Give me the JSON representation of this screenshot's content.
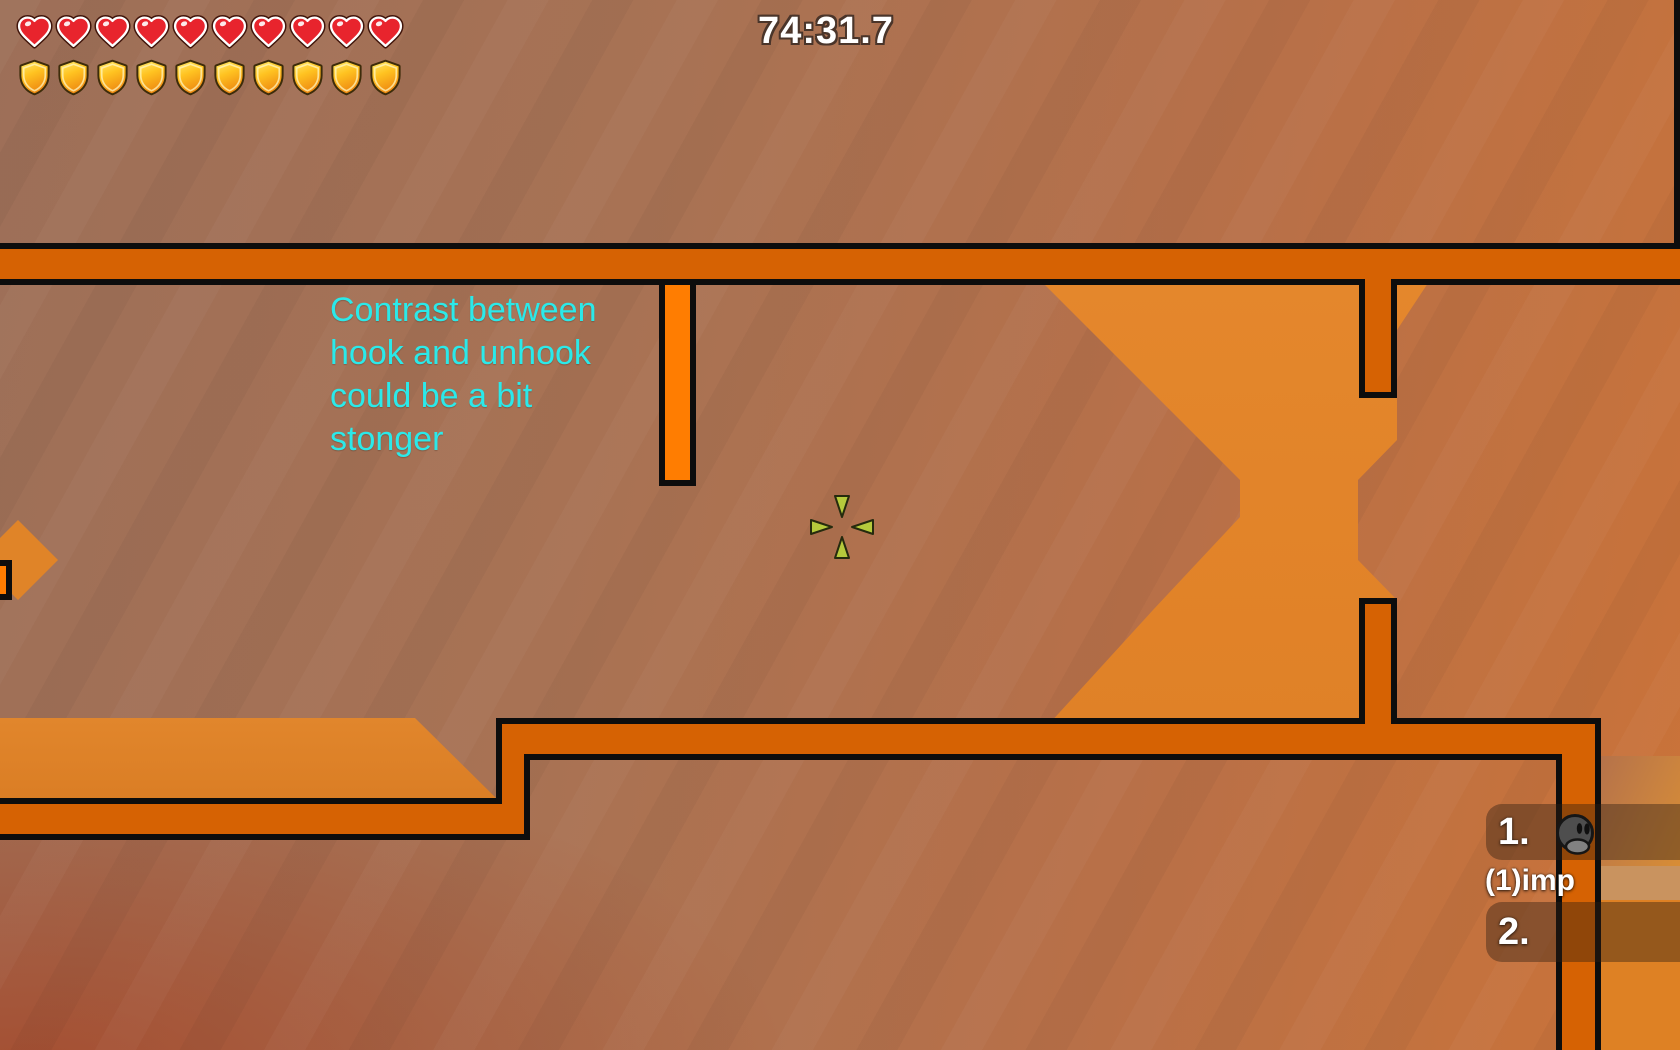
{
  "hud": {
    "timer": "74:31.7",
    "health": 10,
    "armor": 10,
    "health_icon": "heart-icon",
    "armor_icon": "shield-icon"
  },
  "broadcast": {
    "text": "Contrast between\nhook and unhook\ncould be a bit\nstonger",
    "color": "#2BE9E9"
  },
  "spectator_panel": {
    "rows": [
      {
        "rank": "1."
      },
      {
        "rank": "2."
      }
    ],
    "player_name": "(1)imp"
  },
  "cursor": {
    "icon": "crosshair-icon",
    "color": "#B6CA3C"
  },
  "map": {
    "colors": {
      "hookable_tile": "#D66203",
      "unhookable_tile": "#FF7D01",
      "tile_outline": "#0D0D0D",
      "background_quad_orange": "#E0872B",
      "background_brown": "#A87254"
    }
  }
}
